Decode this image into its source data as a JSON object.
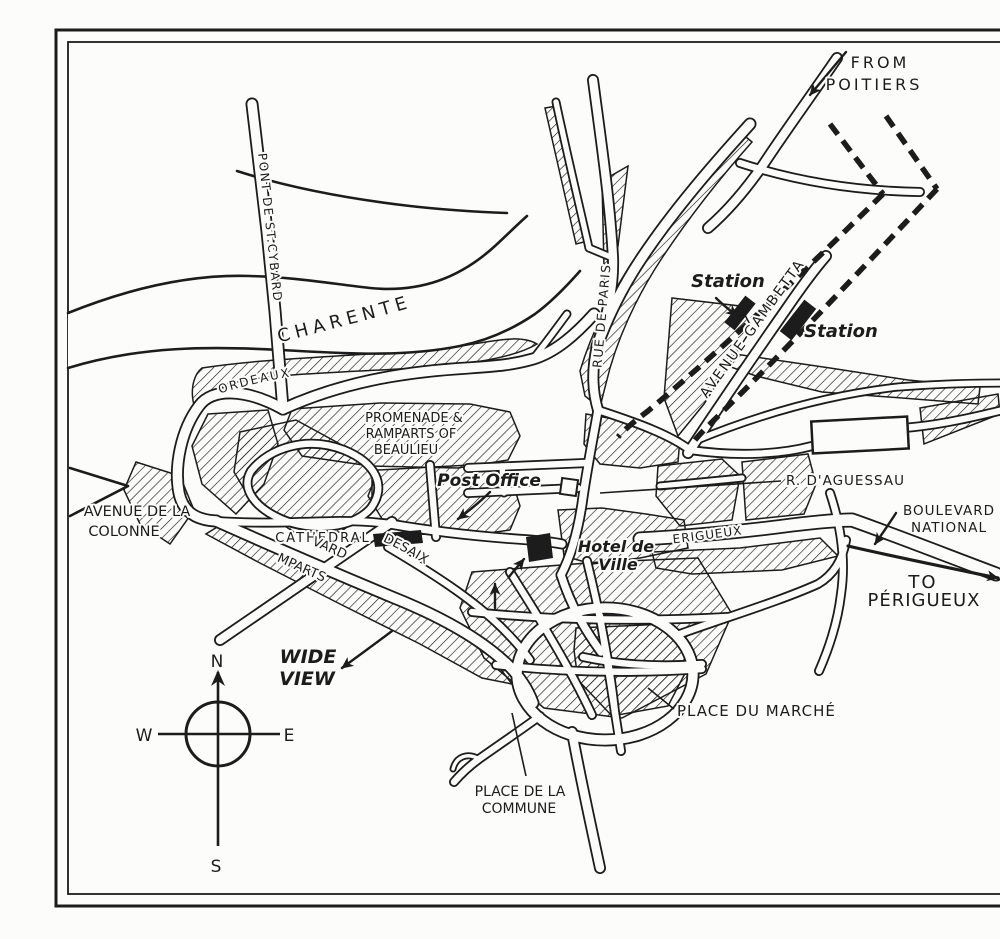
{
  "colors": {
    "ink": "#1c1c1c",
    "paper": "#fcfcfa"
  },
  "compass": {
    "north": "N",
    "south": "S",
    "east": "E",
    "west": "W"
  },
  "labels": {
    "from_poitiers_1": "FROM",
    "from_poitiers_2": "POITIERS",
    "river_charente": "RIVER    CHARENTE",
    "pont_st_cybard": "PONT DE ST.CYBARD",
    "rue_de_paris": "RUE DE PARIS",
    "avenue_gambetta": "AVENUE GAMBETTA",
    "station_1": "Station",
    "station_2": "Station",
    "rue_de_bordeaux": "RUE DE BORDEAUX",
    "promenade_1": "PROMENADE &",
    "promenade_2": "RAMPARTS OF",
    "promenade_3": "BEAULIEU",
    "post_office": "Post Office",
    "r_daguessau": "R. D'AGUESSAU",
    "avenue_colonne_1": "AVENUE DE LA",
    "avenue_colonne_2": "COLONNE",
    "cathedral": "CATHEDRAL",
    "boulevard_ramparts_1": "BOULEVARD",
    "boulevard_ramparts_2": "ON RAMPARTS",
    "bould_desaix": "BOULD. DESAIX",
    "hotel_de_ville_1": "Hotel de",
    "hotel_de_ville_2": "Ville",
    "rue_de_perigueux": "RUE DE PERIGUEUX",
    "boulevard_national_1": "BOULEVARD",
    "boulevard_national_2": "NATIONAL",
    "to_perigueux_1": "TO",
    "to_perigueux_2": "PÉRIGUEUX",
    "wide_view_1": "WIDE",
    "wide_view_2": "VIEW",
    "place_du_marche": "PLACE DU MARCHÉ",
    "place_commune_1": "PLACE DE LA",
    "place_commune_2": "COMMUNE"
  }
}
